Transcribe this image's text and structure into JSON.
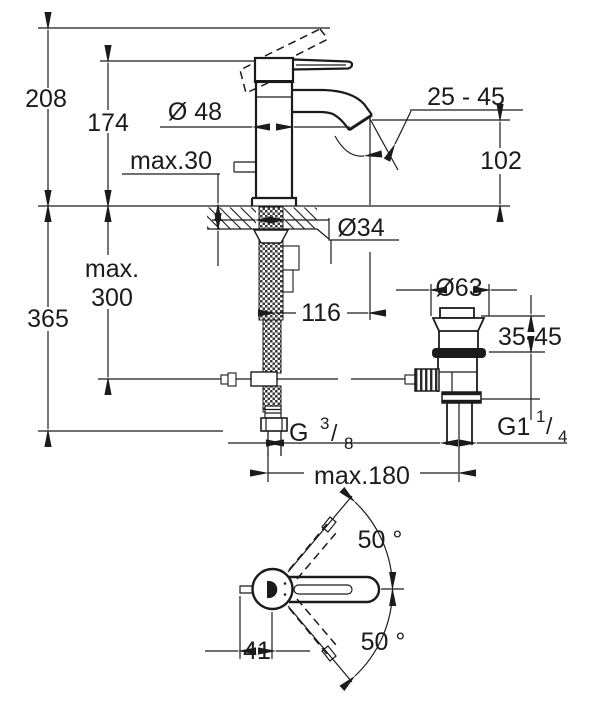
{
  "figure": {
    "title": "Single-lever basin mixer with pop-up waste - dimensioned installation drawing",
    "units": "mm",
    "line_color": "#1b1b1b",
    "background_color": "#ffffff"
  },
  "front_view": {
    "labels": {
      "total_height": "208",
      "body_height": "174",
      "body_diameter": "Ø 48",
      "max_deck_thickness": "max.30",
      "aerator_angle_range": "25 - 45",
      "spout_height": "102",
      "hole_diameter": "Ø34",
      "hose_depth_line1": "max.",
      "hose_depth_line2": "300",
      "overall_depth": "365",
      "spout_reach": "116",
      "waste_flange_diameter": "Ø63",
      "clamping_range": "35-45",
      "max_center_distance": "max.180",
      "supply_thread": {
        "base": "G",
        "numerator": "3",
        "slash": "/",
        "denominator": "8"
      },
      "waste_thread": {
        "base": "G1",
        "numerator": "1",
        "slash": "/",
        "denominator": "4"
      }
    }
  },
  "bottom_view": {
    "labels": {
      "swing_angle_upper": "50 °",
      "swing_angle_lower": "50 °",
      "handle_offset": "41"
    }
  }
}
